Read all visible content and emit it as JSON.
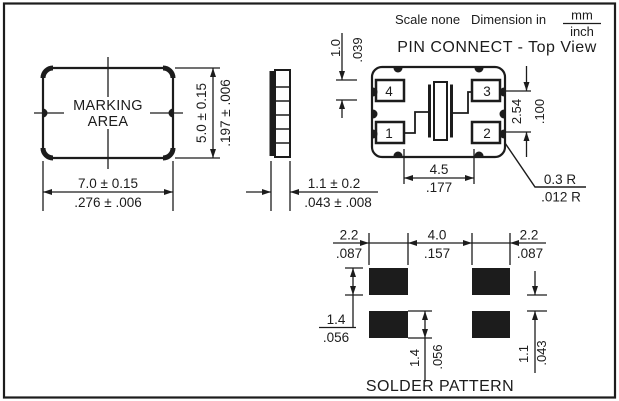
{
  "header": {
    "scale": "Scale none",
    "dimension_in": "Dimension in",
    "unit_numerator": "mm",
    "unit_denominator": "inch"
  },
  "package_view": {
    "marking_line1": "MARKING",
    "marking_line2": "AREA",
    "width_mm": "7.0 ± 0.15",
    "width_inch": ".276 ± .006",
    "height_mm": "5.0 ± 0.15",
    "height_inch": ".197 ± .006"
  },
  "side_view": {
    "thickness_mm": "1.1 ± 0.2",
    "thickness_inch": ".043 ± .008"
  },
  "pin_connect_view": {
    "title": "PIN CONNECT - Top View",
    "pin_labels": {
      "pin1": "1",
      "pin2": "2",
      "pin3": "3",
      "pin4": "4"
    },
    "pad_height_mm": "1.0",
    "pad_height_inch": ".039",
    "pad_span_mm": "4.5",
    "pad_span_inch": ".177",
    "pad_pitch_mm": "2.54",
    "pad_pitch_inch": ".100",
    "corner_radius_mm": "0.3 R",
    "corner_radius_inch": ".012 R"
  },
  "solder_pattern_view": {
    "title": "SOLDER PATTERN",
    "pad_width_left_mm": "2.2",
    "pad_width_left_inch": ".087",
    "pad_gap_mm": "4.0",
    "pad_gap_inch": ".157",
    "pad_width_right_mm": "2.2",
    "pad_width_right_inch": ".087",
    "pad_height_left_mm": "1.4",
    "pad_height_left_inch": ".056",
    "pad_height_mid_mm": "1.4",
    "pad_height_mid_inch": ".056",
    "row_gap_mm": "1.1",
    "row_gap_inch": ".043"
  }
}
